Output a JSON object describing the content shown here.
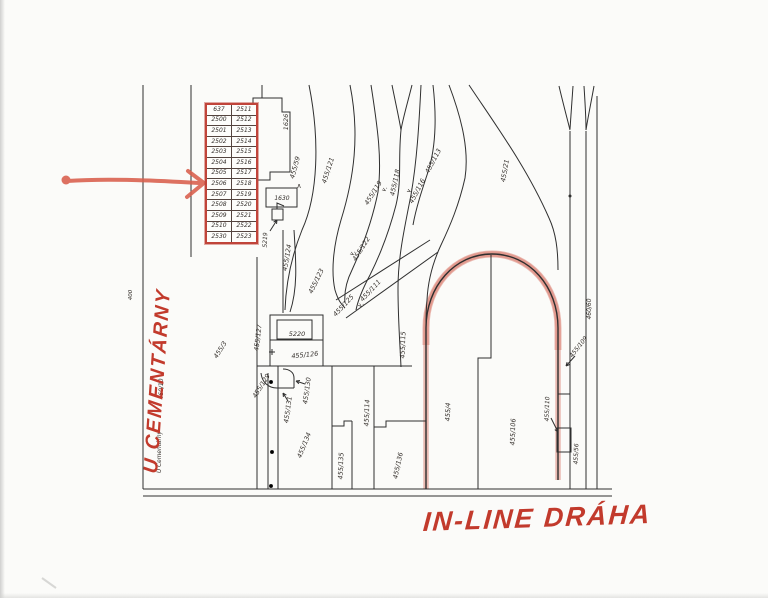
{
  "page": {
    "kind": "scanned cadastral map"
  },
  "annotations": {
    "street_red": {
      "text": "U CEMENTÁRNY",
      "color": "#c23a2c"
    },
    "track_red": {
      "text": "IN-LINE DRÁHA",
      "color": "#c23a2c"
    },
    "arrow_color": "#d95f4d",
    "track_highlight_color": "#d9796b",
    "table_border_color": "#c0443a"
  },
  "parcel_table": {
    "rows": [
      [
        "637",
        "2511"
      ],
      [
        "2500",
        "2512"
      ],
      [
        "2501",
        "2513"
      ],
      [
        "2502",
        "2514"
      ],
      [
        "2503",
        "2515"
      ],
      [
        "2504",
        "2516"
      ],
      [
        "2505",
        "2517"
      ],
      [
        "2506",
        "2518"
      ],
      [
        "2507",
        "2519"
      ],
      [
        "2508",
        "2520"
      ],
      [
        "2509",
        "2521"
      ],
      [
        "2510",
        "2522"
      ],
      [
        "2530",
        "2523"
      ]
    ]
  },
  "map_labels": [
    {
      "text": "1626",
      "x": 288,
      "y": 122,
      "rot": -90,
      "fs": 6.5
    },
    {
      "text": "455/59",
      "x": 297,
      "y": 168,
      "rot": -75,
      "fs": 6.5
    },
    {
      "text": "455/121",
      "x": 330,
      "y": 171,
      "rot": -72,
      "fs": 6.5
    },
    {
      "text": "455/119",
      "x": 375,
      "y": 194,
      "rot": -58,
      "fs": 6.5
    },
    {
      "text": "455/118",
      "x": 397,
      "y": 183,
      "rot": -78,
      "fs": 6.5
    },
    {
      "text": "455/116",
      "x": 419,
      "y": 192,
      "rot": -62,
      "fs": 6.5
    },
    {
      "text": "455/113",
      "x": 435,
      "y": 162,
      "rot": -62,
      "fs": 6.5
    },
    {
      "text": "455/21",
      "x": 507,
      "y": 171,
      "rot": -80,
      "fs": 6.5
    },
    {
      "text": "1630",
      "x": 282,
      "y": 200,
      "rot": 0,
      "fs": 6
    },
    {
      "text": "5219",
      "x": 267,
      "y": 240,
      "rot": -88,
      "fs": 6
    },
    {
      "text": "455/124",
      "x": 289,
      "y": 258,
      "rot": -80,
      "fs": 6.5
    },
    {
      "text": "455/123",
      "x": 318,
      "y": 282,
      "rot": -64,
      "fs": 6.5
    },
    {
      "text": "455/122",
      "x": 363,
      "y": 250,
      "rot": -58,
      "fs": 6.5
    },
    {
      "text": "455/111",
      "x": 372,
      "y": 292,
      "rot": -47,
      "fs": 6.5
    },
    {
      "text": "455/125",
      "x": 345,
      "y": 307,
      "rot": -47,
      "fs": 6.5
    },
    {
      "text": "455/127",
      "x": 260,
      "y": 338,
      "rot": -83,
      "fs": 6.5
    },
    {
      "text": "5220",
      "x": 297,
      "y": 336,
      "rot": 0,
      "fs": 6.5
    },
    {
      "text": "455/126",
      "x": 305,
      "y": 357,
      "rot": -6,
      "fs": 6.5
    },
    {
      "text": "455/115",
      "x": 405,
      "y": 345,
      "rot": -88,
      "fs": 6.5
    },
    {
      "text": "455/129",
      "x": 263,
      "y": 387,
      "rot": -58,
      "fs": 6.5
    },
    {
      "text": "455/130",
      "x": 309,
      "y": 391,
      "rot": -82,
      "fs": 6.5
    },
    {
      "text": "455/131",
      "x": 290,
      "y": 410,
      "rot": -82,
      "fs": 6.5
    },
    {
      "text": "455/134",
      "x": 306,
      "y": 446,
      "rot": -68,
      "fs": 6.5
    },
    {
      "text": "455/114",
      "x": 369,
      "y": 413,
      "rot": -88,
      "fs": 6.5
    },
    {
      "text": "455/135",
      "x": 343,
      "y": 466,
      "rot": -88,
      "fs": 6.5
    },
    {
      "text": "455/136",
      "x": 400,
      "y": 466,
      "rot": -78,
      "fs": 6.5
    },
    {
      "text": "455/4",
      "x": 450,
      "y": 412,
      "rot": -88,
      "fs": 6.5
    },
    {
      "text": "455/106",
      "x": 515,
      "y": 432,
      "rot": -88,
      "fs": 6.5
    },
    {
      "text": "455/110",
      "x": 549,
      "y": 409,
      "rot": -88,
      "fs": 6
    },
    {
      "text": "455/109",
      "x": 580,
      "y": 348,
      "rot": -52,
      "fs": 6
    },
    {
      "text": "455/56",
      "x": 578,
      "y": 454,
      "rot": -88,
      "fs": 6
    },
    {
      "text": "460/60",
      "x": 591,
      "y": 309,
      "rot": -90,
      "fs": 6
    },
    {
      "text": "455/3",
      "x": 222,
      "y": 351,
      "rot": -58,
      "fs": 6.5
    },
    {
      "text": "460/10",
      "x": 163,
      "y": 389,
      "rot": -90,
      "fs": 6
    },
    {
      "text": "U Cementárny",
      "x": 161,
      "y": 452,
      "rot": -90,
      "fs": 5.8
    },
    {
      "text": "400",
      "x": 132,
      "y": 295,
      "rot": -90,
      "fs": 5.5
    }
  ],
  "map_symbols": [
    {
      "text": "∧",
      "x": 299,
      "y": 188,
      "rot": 0,
      "fs": 7
    },
    {
      "text": "∨.",
      "x": 354,
      "y": 254,
      "rot": -58,
      "fs": 6
    },
    {
      "text": "∨.",
      "x": 386,
      "y": 190,
      "rot": -58,
      "fs": 6
    },
    {
      "text": "∨.",
      "x": 411,
      "y": 191,
      "rot": -62,
      "fs": 6
    },
    {
      "text": "∨.",
      "x": 362,
      "y": 306,
      "rot": -47,
      "fs": 6
    }
  ]
}
